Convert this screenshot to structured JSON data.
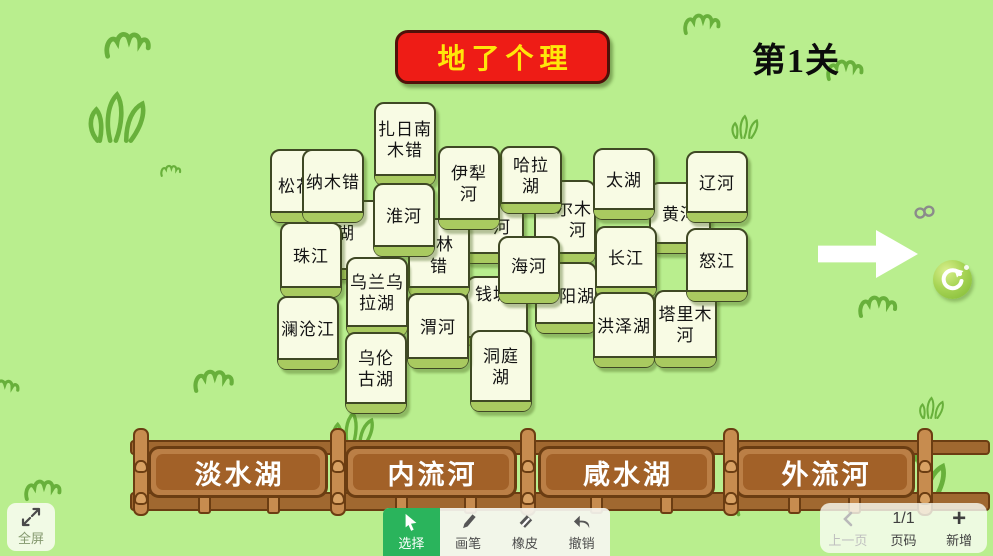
{
  "app": {
    "title": "地了个理",
    "level": "第1关"
  },
  "colors": {
    "background": "#b9ee8e",
    "banner_red": "#ee1c16",
    "banner_text_yellow": "#ffe60a",
    "tile_face": "#f8fbe4",
    "tile_edge_green": "#a9ca60",
    "fence_brown": "#bb7f46",
    "fence_inner_brown": "#a26128",
    "active_tool_green": "#2ab45c",
    "refresh_green": "#8cc63f",
    "grass_stroke": "#68b03b"
  },
  "board": {
    "tiles": [
      {
        "id": "songhua",
        "x": 270,
        "y": 149,
        "w": 62,
        "h": 74,
        "z": 1,
        "frags": [
          {
            "t": "松花",
            "x": 6,
            "y": 26
          }
        ]
      },
      {
        "id": "hidden-hu",
        "x": 332,
        "y": 200,
        "w": 62,
        "h": 80,
        "z": 1,
        "frags": [
          {
            "t": "湖",
            "x": 3,
            "y": 22
          }
        ]
      },
      {
        "id": "hidden-he",
        "x": 462,
        "y": 186,
        "w": 62,
        "h": 78,
        "z": 1,
        "frags": [
          {
            "t": "河",
            "x": 29,
            "y": 30
          }
        ]
      },
      {
        "id": "ermu-he",
        "x": 534,
        "y": 180,
        "w": 62,
        "h": 84,
        "z": 1,
        "frags": [
          {
            "t": "尔木",
            "x": 20,
            "y": 18
          },
          {
            "t": "河",
            "x": 33,
            "y": 39
          }
        ]
      },
      {
        "id": "huanghe",
        "x": 649,
        "y": 182,
        "w": 62,
        "h": 72,
        "z": 1,
        "lines": [
          "黄河"
        ]
      },
      {
        "id": "qiantang",
        "x": 466,
        "y": 276,
        "w": 62,
        "h": 72,
        "z": 2,
        "frags": [
          {
            "t": "钱塘",
            "x": 7,
            "y": 7
          }
        ]
      },
      {
        "id": "yanghu",
        "x": 535,
        "y": 262,
        "w": 62,
        "h": 72,
        "z": 2,
        "frags": [
          {
            "t": "阳湖",
            "x": 22,
            "y": 23
          }
        ]
      },
      {
        "id": "lincuo",
        "x": 408,
        "y": 218,
        "w": 62,
        "h": 80,
        "z": 2,
        "frags": [
          {
            "t": "林",
            "x": 26,
            "y": 15
          },
          {
            "t": "错",
            "x": 20,
            "y": 37
          }
        ]
      },
      {
        "id": "zhari-namco",
        "x": 374,
        "y": 102,
        "w": 62,
        "h": 84,
        "z": 3,
        "lines": [
          "扎日南",
          "木错"
        ]
      },
      {
        "id": "namco",
        "x": 302,
        "y": 149,
        "w": 62,
        "h": 74,
        "z": 3,
        "lines": [
          "纳木错"
        ]
      },
      {
        "id": "halahu",
        "x": 500,
        "y": 146,
        "w": 62,
        "h": 68,
        "z": 3,
        "lines": [
          "哈拉",
          "湖"
        ]
      },
      {
        "id": "taihu",
        "x": 593,
        "y": 148,
        "w": 62,
        "h": 72,
        "z": 4,
        "lines": [
          "太湖"
        ]
      },
      {
        "id": "liaohe",
        "x": 686,
        "y": 151,
        "w": 62,
        "h": 72,
        "z": 4,
        "lines": [
          "辽河"
        ]
      },
      {
        "id": "huaihe",
        "x": 373,
        "y": 183,
        "w": 62,
        "h": 74,
        "z": 4,
        "lines": [
          "淮河"
        ]
      },
      {
        "id": "yilihe",
        "x": 438,
        "y": 146,
        "w": 62,
        "h": 84,
        "z": 4,
        "lines": [
          "伊犁",
          "河"
        ]
      },
      {
        "id": "zhujiang",
        "x": 280,
        "y": 222,
        "w": 62,
        "h": 76,
        "z": 4,
        "lines": [
          "珠江"
        ]
      },
      {
        "id": "lancangjiang",
        "x": 277,
        "y": 296,
        "w": 62,
        "h": 74,
        "z": 4,
        "lines": [
          "澜沧江"
        ]
      },
      {
        "id": "wulanwula",
        "x": 346,
        "y": 257,
        "w": 62,
        "h": 80,
        "z": 4,
        "lines": [
          "乌兰乌",
          "拉湖"
        ]
      },
      {
        "id": "wulungu",
        "x": 345,
        "y": 332,
        "w": 62,
        "h": 82,
        "z": 4,
        "lines": [
          "乌伦",
          "古湖"
        ]
      },
      {
        "id": "dongtinghu",
        "x": 470,
        "y": 330,
        "w": 62,
        "h": 82,
        "z": 4,
        "lines": [
          "洞庭",
          "湖"
        ]
      },
      {
        "id": "weihe",
        "x": 407,
        "y": 293,
        "w": 62,
        "h": 76,
        "z": 5,
        "lines": [
          "渭河"
        ]
      },
      {
        "id": "haihe",
        "x": 498,
        "y": 236,
        "w": 62,
        "h": 68,
        "z": 5,
        "lines": [
          "海河"
        ]
      },
      {
        "id": "changjiang",
        "x": 595,
        "y": 226,
        "w": 62,
        "h": 72,
        "z": 5,
        "lines": [
          "长江"
        ]
      },
      {
        "id": "hongzehu",
        "x": 593,
        "y": 292,
        "w": 62,
        "h": 76,
        "z": 5,
        "lines": [
          "洪泽湖"
        ]
      },
      {
        "id": "talimuhe",
        "x": 654,
        "y": 290,
        "w": 63,
        "h": 78,
        "z": 5,
        "lines": [
          "塔里木",
          "河"
        ]
      },
      {
        "id": "nujiang",
        "x": 686,
        "y": 228,
        "w": 62,
        "h": 74,
        "z": 6,
        "lines": [
          "怒江"
        ]
      }
    ]
  },
  "fence": {
    "categories": [
      "淡水湖",
      "内流河",
      "咸水湖",
      "外流河"
    ],
    "posts_x": [
      5,
      202,
      392,
      595,
      789
    ],
    "pickets_x": [
      70,
      139,
      267,
      336,
      462,
      532,
      660,
      720
    ]
  },
  "toolbar": {
    "select": "选择",
    "pen": "画笔",
    "eraser": "橡皮",
    "undo": "撤销"
  },
  "pager": {
    "prev": "上一页",
    "page": "1/1",
    "page_label": "页码",
    "add": "新增"
  },
  "fullscreen_label": "全屏",
  "icons": {
    "next": "right-arrow",
    "refresh": "circular-arrow",
    "chain": "link",
    "fullscreen": "expand-arrows",
    "select": "cursor-arrow",
    "pen": "pencil",
    "eraser": "eraser",
    "undo": "undo-arrow",
    "prev": "chevron-left",
    "add": "plus",
    "grass": "grass-tuft",
    "squiggle": "grass-squiggle"
  },
  "decorations": [
    {
      "icon": "squiggle-icon",
      "x": 104,
      "y": 30,
      "s": 1.2
    },
    {
      "icon": "grass-icon",
      "x": 86,
      "y": 90,
      "s": 1.15
    },
    {
      "icon": "squiggle-icon",
      "x": 160,
      "y": 164,
      "s": 0.55
    },
    {
      "icon": "squiggle-icon",
      "x": 683,
      "y": 12,
      "s": 0.95
    },
    {
      "icon": "squiggle-icon",
      "x": 826,
      "y": 58,
      "s": 0.95
    },
    {
      "icon": "grass-icon",
      "x": 730,
      "y": 114,
      "s": 0.55
    },
    {
      "icon": "squiggle-icon",
      "x": 552,
      "y": 280,
      "s": 0.85
    },
    {
      "icon": "squiggle-icon",
      "x": 858,
      "y": 294,
      "s": 1.0
    },
    {
      "icon": "squiggle-icon",
      "x": 193,
      "y": 368,
      "s": 1.05
    },
    {
      "icon": "squiggle-icon",
      "x": -12,
      "y": 378,
      "s": 0.8
    },
    {
      "icon": "grass-icon",
      "x": 330,
      "y": 410,
      "s": 0.85
    },
    {
      "icon": "squiggle-icon",
      "x": 24,
      "y": 478,
      "s": 0.95
    },
    {
      "icon": "grass-icon",
      "x": 884,
      "y": 452,
      "s": 1.2
    },
    {
      "icon": "grass-icon",
      "x": 918,
      "y": 396,
      "s": 0.5
    },
    {
      "icon": "squiggle-icon",
      "x": 736,
      "y": 496,
      "s": 0.85
    },
    {
      "icon": "grass-icon",
      "x": 572,
      "y": 466,
      "s": 0.85
    }
  ]
}
